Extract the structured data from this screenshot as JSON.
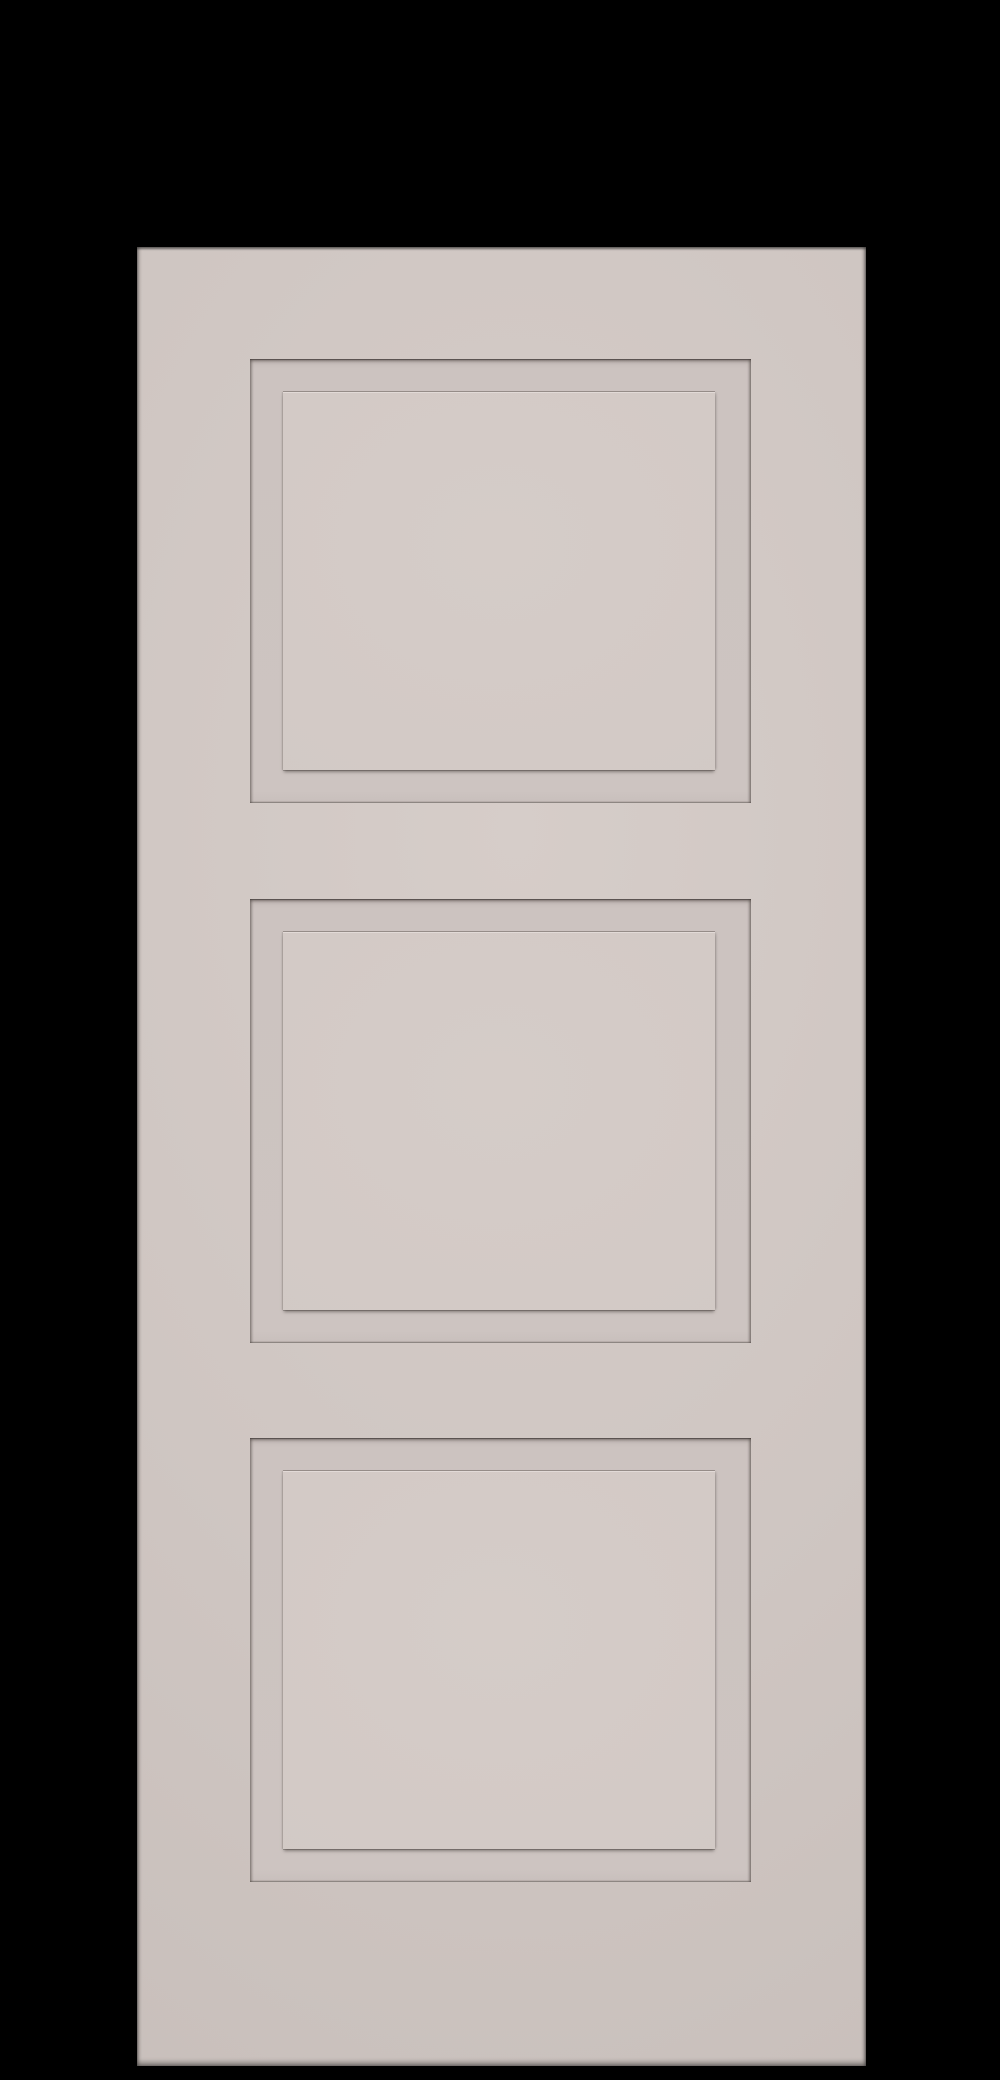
{
  "scene": {
    "type": "product-render",
    "label": "Three-panel shaker style interior door rendered on a black background",
    "background_label": "solid black backdrop"
  },
  "door": {
    "label": "Greige painted door slab with three recessed square panels",
    "panels": [
      {
        "name": "door-panel-top",
        "label": "Top recessed panel with raised center"
      },
      {
        "name": "door-panel-middle",
        "label": "Middle recessed panel with raised center"
      },
      {
        "name": "door-panel-bottom",
        "label": "Bottom recessed panel with raised center"
      }
    ]
  },
  "colors": {
    "background": "#000000",
    "door-face": "#cfc6c2",
    "door-face-light": "#d6cdc9",
    "door-face-dark": "#c7beba",
    "panel-face": "#d2c9c5",
    "panel-face-light": "#d5ccc8",
    "panel-highlight": "#e2dad7",
    "groove-shadow": "#3a3330"
  }
}
